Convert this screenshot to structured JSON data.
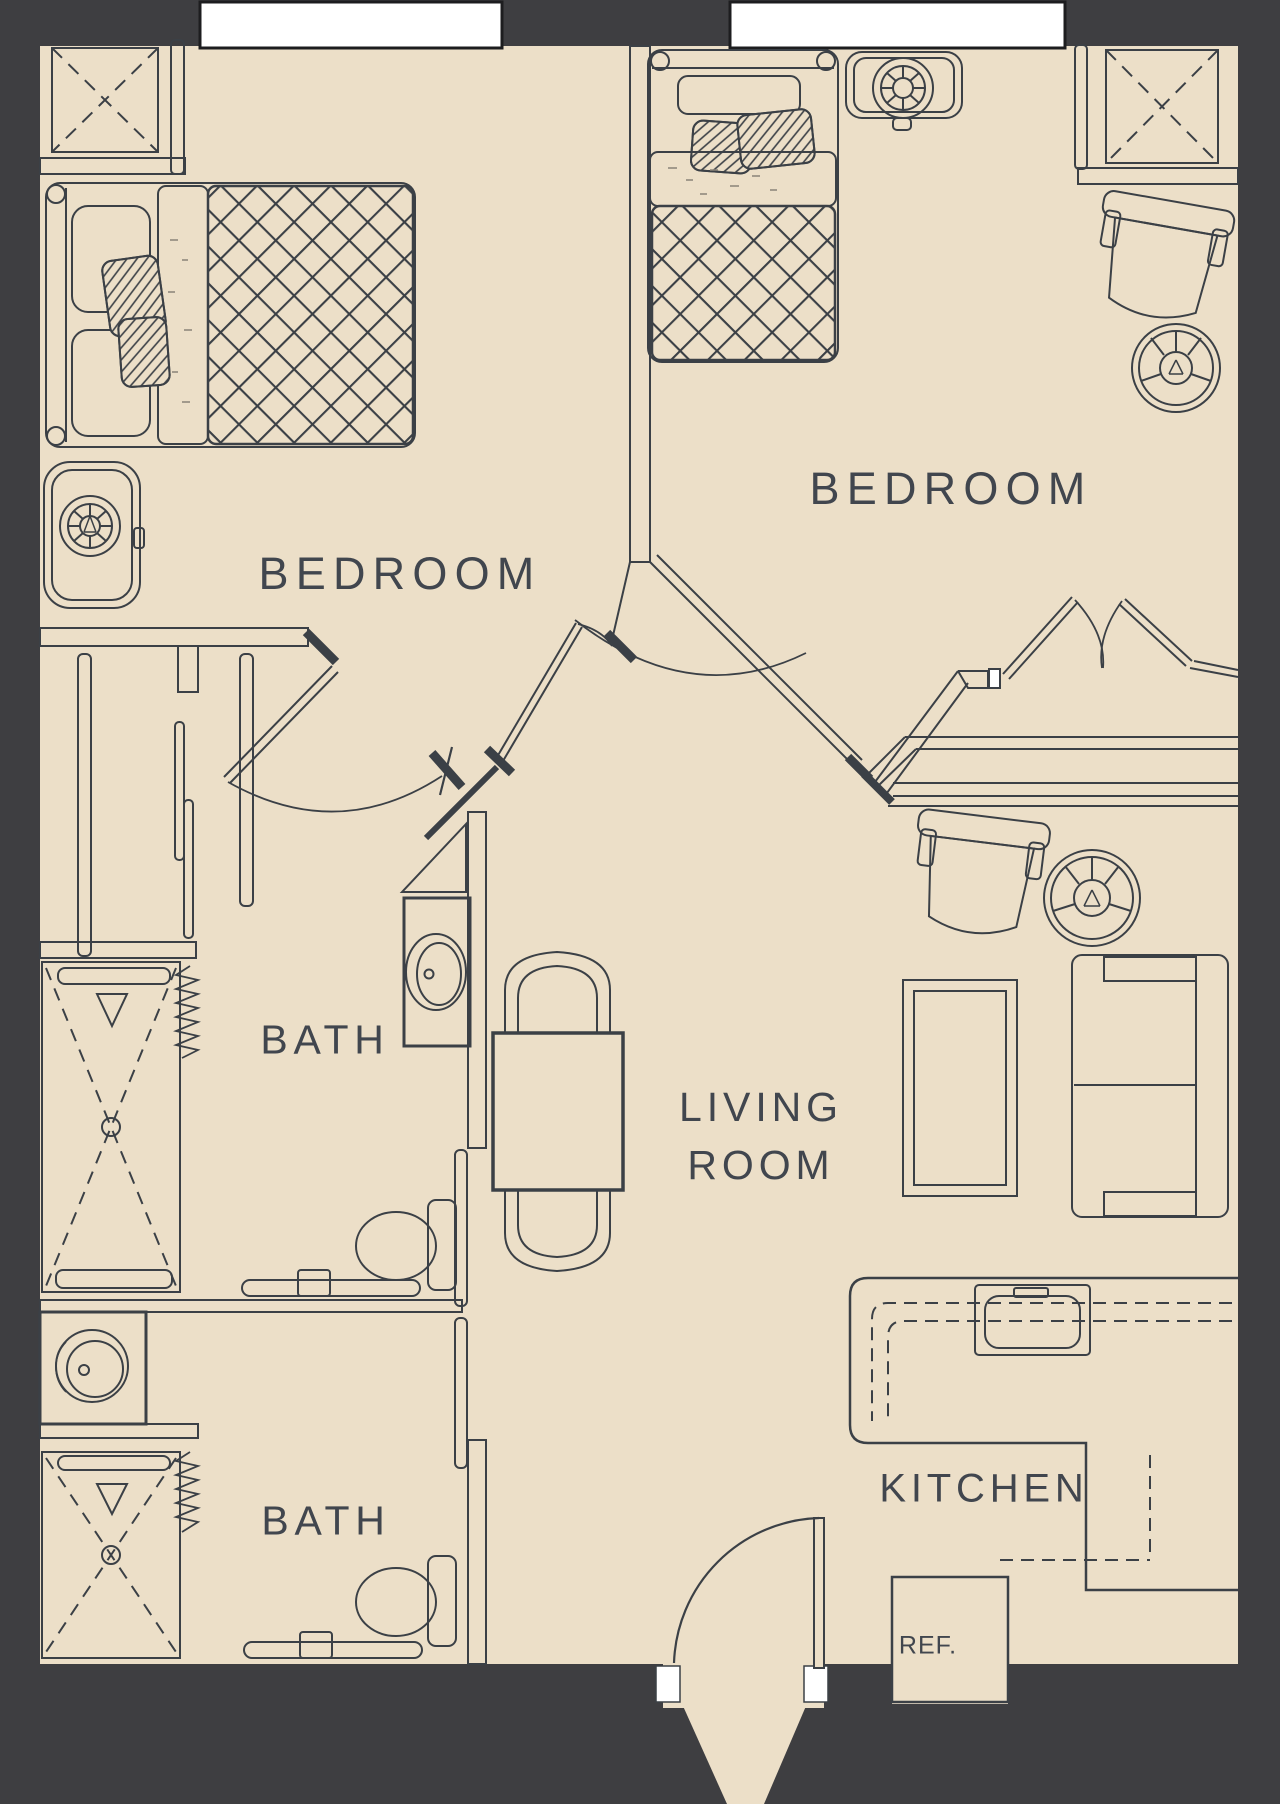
{
  "plan": {
    "type": "apartment-floor-plan",
    "rooms": {
      "bedroom_left": "BEDROOM",
      "bedroom_right": "BEDROOM",
      "bath_upper": "BATH",
      "bath_lower": "BATH",
      "living_room": "LIVING\nROOM",
      "kitchen": "KITCHEN",
      "refrigerator": "REF."
    },
    "colors": {
      "wall_dark": "#3e3e41",
      "floor_beige": "#ecdfc8",
      "line": "#3b4046",
      "label_text": "#41464e",
      "window_white": "#ffffff"
    },
    "furniture_icons": [
      "bed",
      "wardrobe",
      "closet",
      "dresser",
      "fan-stool",
      "armchair",
      "side-table",
      "sofa",
      "coffee-table",
      "dining-table",
      "dining-chair",
      "sink-vanity",
      "toilet",
      "shower",
      "kitchen-counter",
      "kitchen-sink",
      "refrigerator",
      "entry-door",
      "french-doors"
    ]
  }
}
